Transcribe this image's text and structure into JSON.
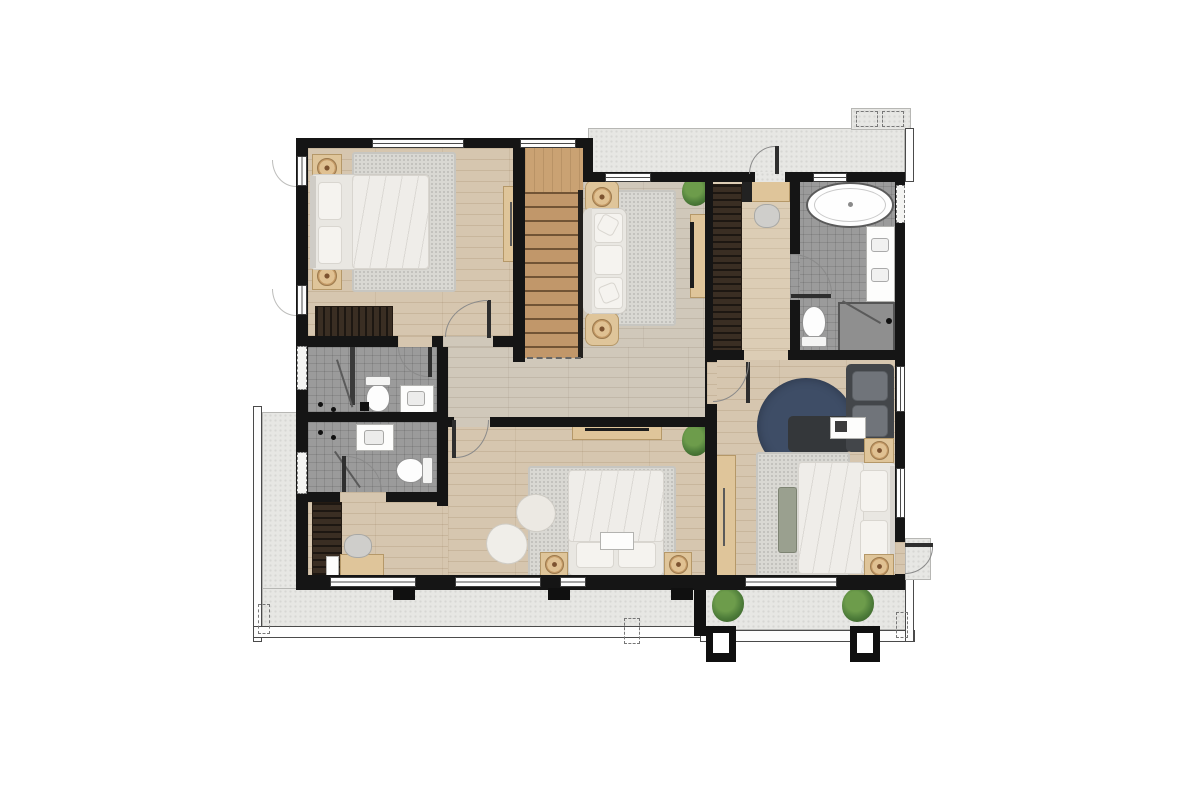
{
  "document": {
    "type": "architectural-floor-plan",
    "view": "rendered-top-down",
    "floor": "upper-floor",
    "visible_text": "none"
  },
  "palette": {
    "wall": "#151515",
    "wood_warm": "#d6c6af",
    "wood_hall": "#d0c8ba",
    "wood_light": "#dccdb5",
    "tile": "#9b9b9b",
    "concrete": "#e7e7e4",
    "stair_wood": "#c1976a",
    "stair_landing": "#caa273",
    "wardrobe_dark": "#3a2e23",
    "rug_gray": "#d9d8d3",
    "rug_navy": "#3e4d66",
    "furniture_wood": "#dfc59a",
    "sofa_charcoal": "#43464a",
    "cushion_gray": "#70747a",
    "linen_white": "#e9e7e2",
    "plant_green": "#4e7d3a",
    "window_white": "#fdfdfd",
    "door_arc": "#8a8a8a",
    "glass_gray": "#5a5a5a"
  },
  "rooms": [
    {
      "id": "bedroom-2",
      "position": "top-left",
      "furniture": [
        "double-bed",
        "nightstand-x2",
        "table-lamp-x2",
        "area-rug",
        "wardrobe",
        "wall-console"
      ]
    },
    {
      "id": "staircase",
      "position": "top-center-left",
      "furniture": [
        "upper-landing",
        "wood-treads-x12",
        "handrail"
      ]
    },
    {
      "id": "family-sitting-area",
      "position": "top-center",
      "furniture": [
        "sofa",
        "side-table-x2",
        "table-lamp-x2",
        "area-rug",
        "tv-console",
        "plant"
      ]
    },
    {
      "id": "walk-in-closet",
      "position": "top-right-inner",
      "furniture": [
        "wardrobe-run",
        "vanity-desk",
        "stool"
      ]
    },
    {
      "id": "master-bathroom",
      "position": "top-right",
      "furniture": [
        "freestanding-bathtub",
        "double-sink-vanity",
        "toilet",
        "walk-in-shower"
      ]
    },
    {
      "id": "bathroom-2-ensuite",
      "position": "mid-left-upper",
      "furniture": [
        "shower",
        "toilet",
        "sink-vanity"
      ]
    },
    {
      "id": "bathroom-3",
      "position": "mid-left-lower",
      "furniture": [
        "shower",
        "toilet",
        "sink-vanity"
      ]
    },
    {
      "id": "hallway",
      "position": "center",
      "furniture": []
    },
    {
      "id": "bedroom-3",
      "position": "bottom-center",
      "furniture": [
        "double-bed",
        "nightstand-x2",
        "table-lamp-x2",
        "area-rug",
        "lounge-chair",
        "ottoman",
        "tv-console",
        "desk",
        "desk-chair",
        "wardrobe",
        "plant"
      ]
    },
    {
      "id": "master-bedroom",
      "position": "bottom-right",
      "furniture": [
        "double-bed",
        "nightstand-x2",
        "table-lamp-x2",
        "bench",
        "area-rug",
        "round-navy-rug",
        "charcoal-chaise-sofa",
        "tray-table",
        "wall-console"
      ]
    },
    {
      "id": "upper-balcony",
      "position": "top-strip",
      "furniture": [
        "balcony-door",
        "ac-platform-x2"
      ]
    },
    {
      "id": "terrace-l-shaped",
      "position": "bottom-left-wrap",
      "furniture": [
        "railing",
        "downspout-dashed-x2"
      ]
    },
    {
      "id": "master-balcony",
      "position": "bottom-right-strip",
      "furniture": [
        "plant-x2",
        "column-x2",
        "railing",
        "balcony-door"
      ]
    }
  ]
}
